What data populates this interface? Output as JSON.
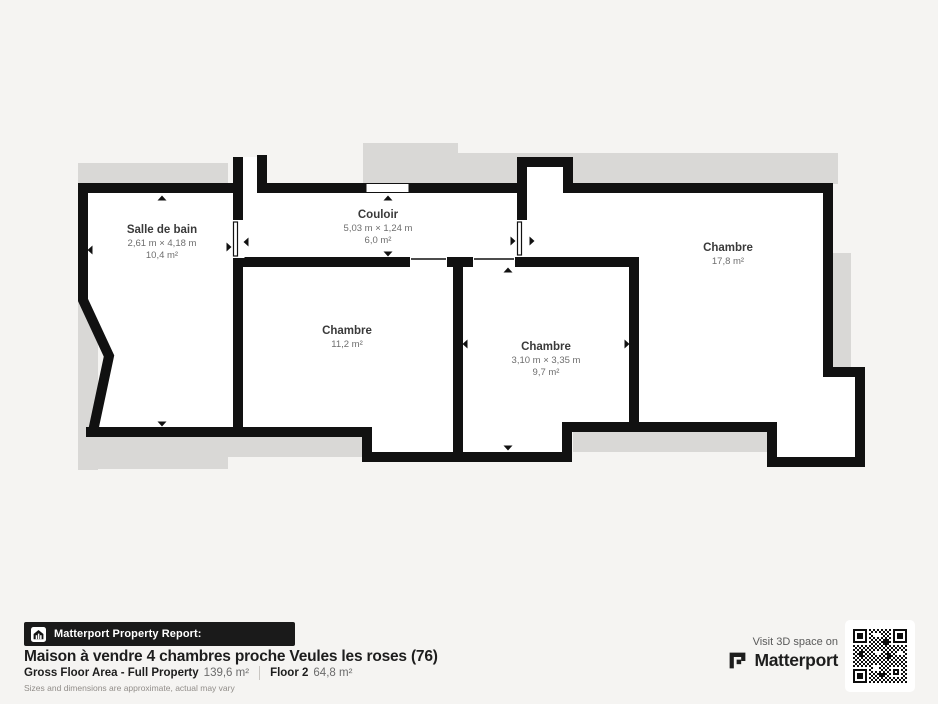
{
  "plan": {
    "rooms": {
      "salle_de_bain": {
        "name": "Salle de bain",
        "dimensions": "2,61 m × 4,18 m",
        "area": "10,4 m²"
      },
      "couloir": {
        "name": "Couloir",
        "dimensions": "5,03 m × 1,24 m",
        "area": "6,0 m²"
      },
      "chambre_1": {
        "name": "Chambre",
        "area": "11,2 m²"
      },
      "chambre_2": {
        "name": "Chambre",
        "dimensions": "3,10 m × 3,35 m",
        "area": "9,7 m²"
      },
      "chambre_3": {
        "name": "Chambre",
        "area": "17,8 m²"
      }
    }
  },
  "footer": {
    "report_label": "Matterport Property Report:",
    "title": "Maison à vendre 4 chambres proche Veules les roses (76)",
    "gross_floor_label": "Gross Floor Area - Full Property",
    "gross_floor_value": "139,6 m²",
    "floor_label": "Floor 2",
    "floor_value": "64,8 m²",
    "disclaimer": "Sizes and dimensions are approximate, actual may vary"
  },
  "branding": {
    "visit_text": "Visit 3D space on",
    "brand_name": "Matterport"
  },
  "colors": {
    "background": "#f5f4f2",
    "wall": "#111111",
    "room_fill": "#ffffff",
    "underlay_gray": "#d9d8d6",
    "banner_bg": "#1a1a1a",
    "text_dark": "#1d1d1d",
    "text_gray": "#6b6b6b"
  }
}
